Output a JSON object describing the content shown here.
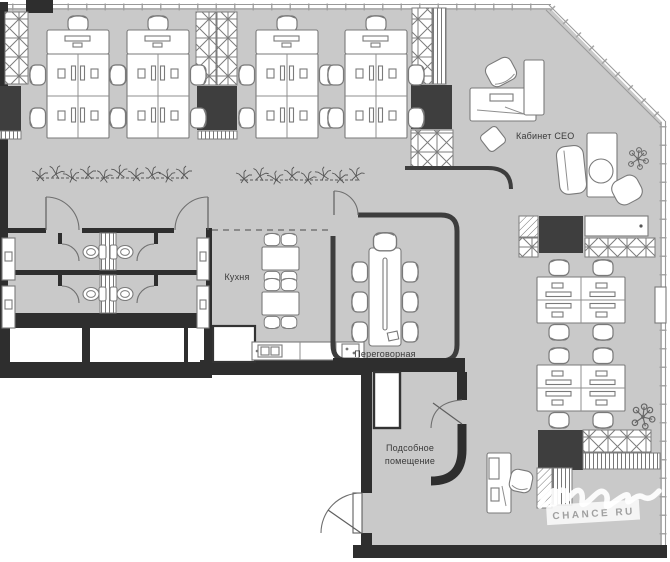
{
  "plan": {
    "type": "office-floor-plan",
    "labels": {
      "ceo": "Кабинет CEO",
      "kitchen": "Кухня",
      "meeting": "Переговорная",
      "utility_line1": "Подсобное",
      "utility_line2": "помещение"
    },
    "watermark": {
      "brand": "CHANCE RU"
    },
    "colors": {
      "floor": "#c9c9c9",
      "wall": "#2e2e2e",
      "dark_block": "#3e3e3e",
      "furniture_stroke": "#7a7a7a",
      "label_text": "#3a3a3a",
      "watermark_text": "#a0a0a0",
      "outside": "#ffffff"
    }
  }
}
